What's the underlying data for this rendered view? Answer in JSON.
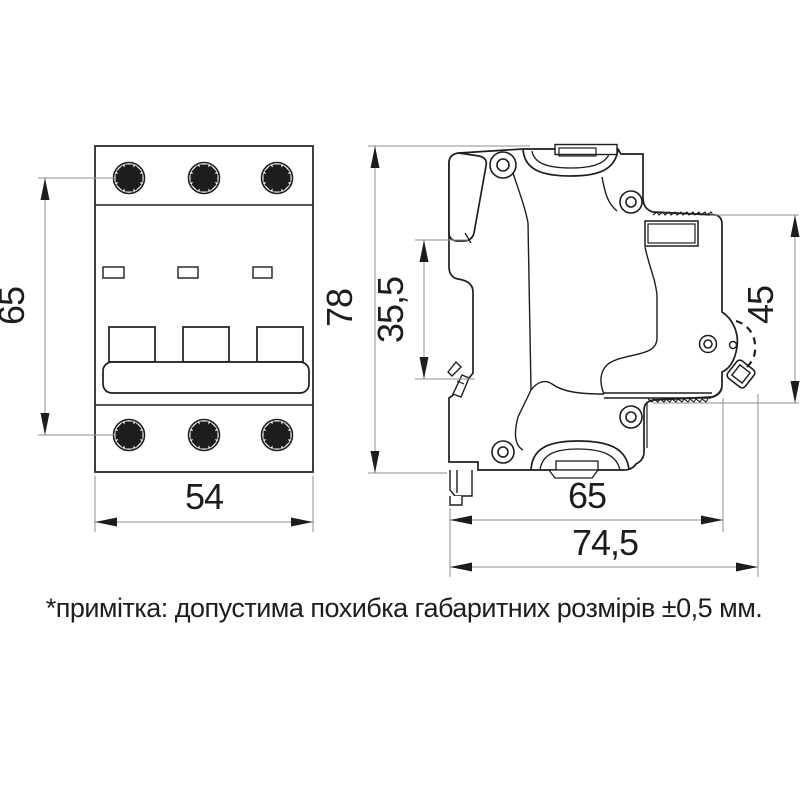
{
  "drawing": {
    "subject": "3-pole modular circuit breaker — dimensional drawing (front and side views)",
    "note": "*примітка: допустима похибка габаритних розмірів ±0,5 мм.",
    "colors": {
      "line": "#1d1d1d",
      "dim_line": "#8f8f8f",
      "text": "#1d1d1d",
      "background": "#ffffff"
    },
    "front_view": {
      "height_mm": "65",
      "width_mm": "54"
    },
    "side_view": {
      "height_mm": "78",
      "din_slot_mm": "35,5",
      "upper_depth_mm": "45",
      "body_depth_mm": "65",
      "total_depth_mm": "74,5"
    }
  }
}
